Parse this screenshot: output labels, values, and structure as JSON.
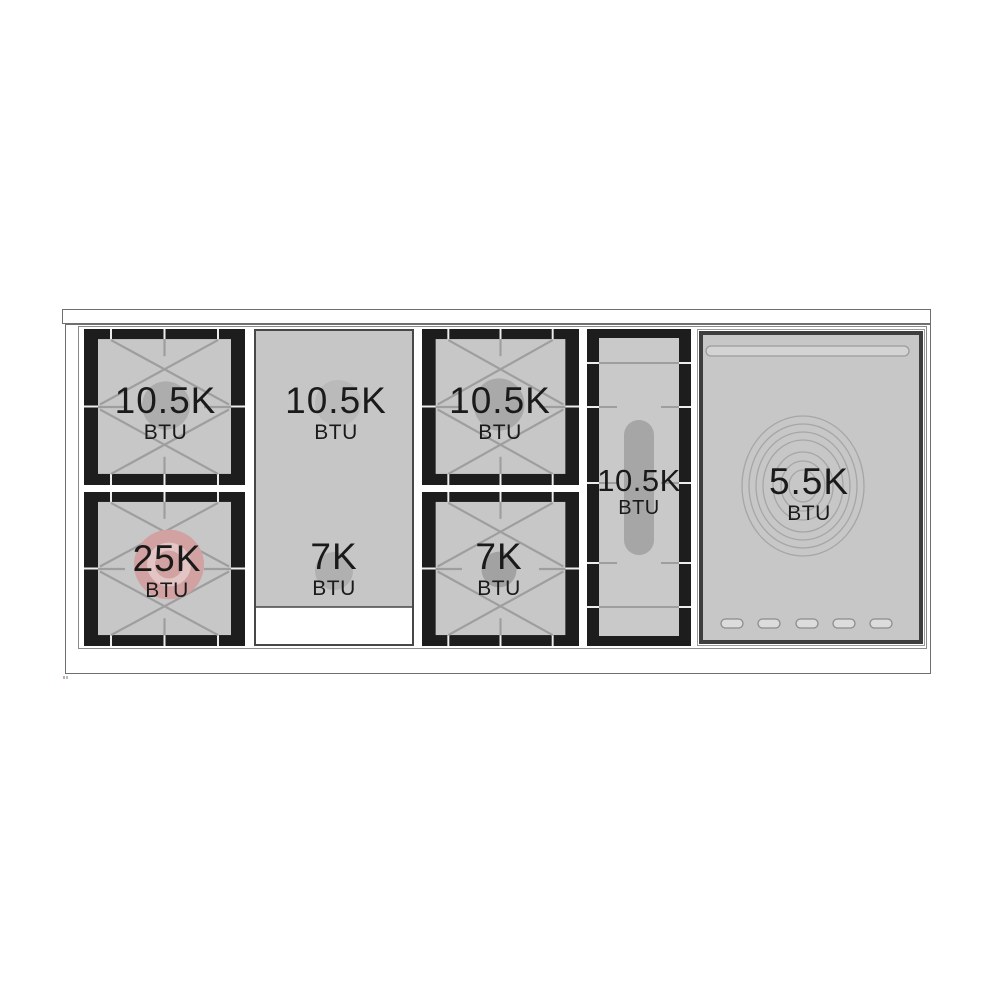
{
  "diagram": {
    "kind": "gas-range-cooktop-burner-diagram",
    "burners": [
      {
        "position": "left-rear",
        "value": "10.5K",
        "unit": "BTU"
      },
      {
        "position": "left-front",
        "value": "25K",
        "unit": "BTU",
        "highlighted": true
      },
      {
        "position": "griddle-rear",
        "value": "10.5K",
        "unit": "BTU"
      },
      {
        "position": "griddle-front",
        "value": "7K",
        "unit": "BTU"
      },
      {
        "position": "center-rear",
        "value": "10.5K",
        "unit": "BTU"
      },
      {
        "position": "center-front",
        "value": "7K",
        "unit": "BTU"
      },
      {
        "position": "oval-center",
        "value": "10.5K",
        "unit": "BTU"
      },
      {
        "position": "french-top",
        "value": "5.5K",
        "unit": "BTU"
      }
    ],
    "colors": {
      "grate_black": "#1d1d1d",
      "surface_gray": "#c7c7c7",
      "burner_circle_gray": "#adadad",
      "power_burner_pink": "#d2a1a1",
      "grate_line_gray": "#9e9e9e",
      "panel_border": "#3e3e3e",
      "label_text": "#1a1a1a"
    }
  }
}
